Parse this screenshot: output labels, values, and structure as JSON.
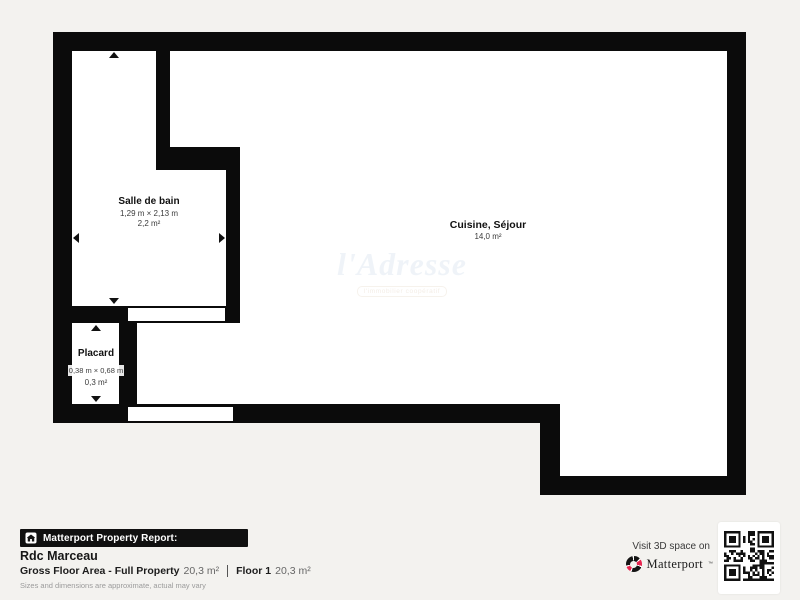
{
  "plan": {
    "rooms": [
      {
        "name": "Salle de bain",
        "dimensions": "1,29 m × 2,13 m",
        "area": "2,2 m²"
      },
      {
        "name": "Placard",
        "dimensions": "0,38 m × 0,68 m",
        "area": "0,3 m²"
      },
      {
        "name": "Cuisine, Séjour",
        "area": "14,0 m²"
      }
    ],
    "watermark": {
      "brand": "l'Adresse",
      "tagline": "l'immobilier coopératif"
    }
  },
  "footer": {
    "report_label": "Matterport Property Report:",
    "title": "Rdc Marceau",
    "gross_label": "Gross Floor Area - Full Property",
    "gross_value": "20,3 m²",
    "floor_label": "Floor 1",
    "floor_value": "20,3 m²",
    "disclaimer": "Sizes and dimensions are approximate, actual may vary",
    "visit_text": "Visit 3D space on",
    "brand": "Matterport",
    "brand_mark": "™"
  },
  "colors": {
    "wall": "#0b0b0b",
    "background": "#f3f2ef",
    "accent_red": "#e8254f"
  }
}
